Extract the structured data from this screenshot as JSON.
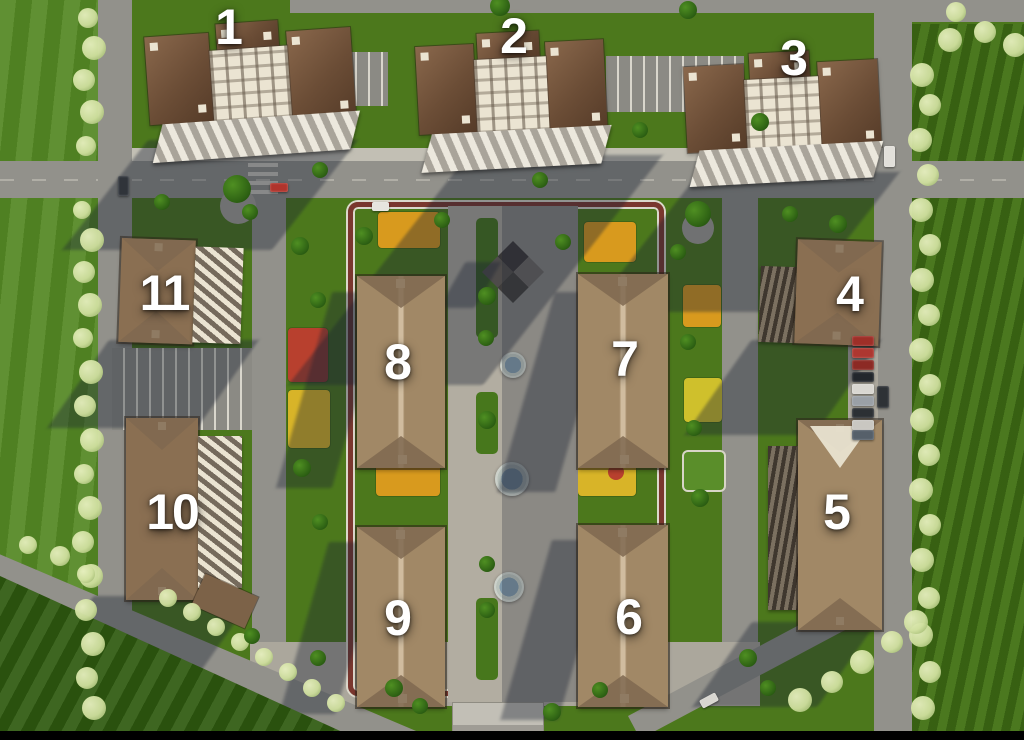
{
  "scene": {
    "title": "Residential complex aerial master plan",
    "type": "3d-aerial-render",
    "building_count": 11
  },
  "buildings": [
    {
      "label": "1",
      "kind": "high-rise-tower"
    },
    {
      "label": "2",
      "kind": "high-rise-tower"
    },
    {
      "label": "3",
      "kind": "high-rise-tower"
    },
    {
      "label": "4",
      "kind": "perimeter-mid-rise"
    },
    {
      "label": "5",
      "kind": "perimeter-mid-rise"
    },
    {
      "label": "6",
      "kind": "courtyard-mid-rise"
    },
    {
      "label": "7",
      "kind": "courtyard-mid-rise"
    },
    {
      "label": "8",
      "kind": "courtyard-mid-rise"
    },
    {
      "label": "9",
      "kind": "courtyard-mid-rise"
    },
    {
      "label": "10",
      "kind": "perimeter-mid-rise"
    },
    {
      "label": "11",
      "kind": "perimeter-mid-rise"
    }
  ],
  "colors": {
    "grass": "#4c781c",
    "road": "#92918b",
    "paving": "#aba79c",
    "roof_tan": "#a18866",
    "hip_shade": "#7f6850",
    "facade": "#ebe4d2",
    "stripe_dark": "#756a5c",
    "track": "#7a372e",
    "track_edge": "#dcd8cc",
    "playground_orange": "#d89a1e",
    "playground_yellow": "#d8b428",
    "playground_red": "#b8402e",
    "playground_green": "#5a8e2a",
    "water": "#7f98a8",
    "fountain_rim": "#ccd1ca",
    "shadow": "rgba(26,33,50,0.38)",
    "tree_green": "#2f6314",
    "tree_flower": "#cfdf9e",
    "label": "#ffffff",
    "letterbox": "#000000"
  },
  "decor": {
    "flowering_trees": [
      [
        88,
        18,
        10
      ],
      [
        94,
        48,
        12
      ],
      [
        84,
        80,
        11
      ],
      [
        92,
        112,
        12
      ],
      [
        86,
        146,
        10
      ],
      [
        82,
        210,
        9
      ],
      [
        92,
        240,
        12
      ],
      [
        84,
        272,
        11
      ],
      [
        90,
        305,
        12
      ],
      [
        83,
        338,
        10
      ],
      [
        91,
        372,
        12
      ],
      [
        85,
        406,
        11
      ],
      [
        92,
        440,
        12
      ],
      [
        84,
        474,
        10
      ],
      [
        90,
        508,
        12
      ],
      [
        83,
        542,
        11
      ],
      [
        91,
        576,
        12
      ],
      [
        86,
        610,
        11
      ],
      [
        93,
        644,
        12
      ],
      [
        87,
        678,
        11
      ],
      [
        94,
        708,
        12
      ],
      [
        922,
        75,
        12
      ],
      [
        930,
        105,
        11
      ],
      [
        920,
        140,
        12
      ],
      [
        928,
        175,
        11
      ],
      [
        921,
        210,
        12
      ],
      [
        930,
        245,
        11
      ],
      [
        922,
        280,
        12
      ],
      [
        929,
        315,
        11
      ],
      [
        921,
        350,
        12
      ],
      [
        930,
        385,
        11
      ],
      [
        922,
        420,
        12
      ],
      [
        929,
        455,
        11
      ],
      [
        921,
        490,
        12
      ],
      [
        930,
        525,
        11
      ],
      [
        922,
        560,
        12
      ],
      [
        929,
        598,
        11
      ],
      [
        921,
        635,
        12
      ],
      [
        930,
        672,
        11
      ],
      [
        923,
        708,
        12
      ],
      [
        950,
        40,
        12
      ],
      [
        985,
        32,
        11
      ],
      [
        1015,
        45,
        12
      ],
      [
        956,
        12,
        10
      ],
      [
        168,
        598,
        9
      ],
      [
        192,
        612,
        9
      ],
      [
        216,
        627,
        9
      ],
      [
        240,
        642,
        9
      ],
      [
        264,
        657,
        9
      ],
      [
        288,
        672,
        9
      ],
      [
        312,
        688,
        9
      ],
      [
        336,
        703,
        9
      ],
      [
        800,
        700,
        12
      ],
      [
        832,
        682,
        11
      ],
      [
        862,
        662,
        12
      ],
      [
        892,
        642,
        11
      ],
      [
        916,
        622,
        12
      ],
      [
        60,
        556,
        10
      ],
      [
        28,
        545,
        9
      ],
      [
        86,
        574,
        9
      ]
    ],
    "green_trees": [
      [
        237,
        189,
        14
      ],
      [
        698,
        214,
        13
      ],
      [
        364,
        236,
        9
      ],
      [
        442,
        220,
        8
      ],
      [
        487,
        296,
        9
      ],
      [
        486,
        338,
        8
      ],
      [
        487,
        420,
        9
      ],
      [
        487,
        564,
        8
      ],
      [
        487,
        610,
        8
      ],
      [
        563,
        242,
        8
      ],
      [
        300,
        246,
        9
      ],
      [
        318,
        300,
        8
      ],
      [
        302,
        468,
        9
      ],
      [
        320,
        522,
        8
      ],
      [
        688,
        342,
        8
      ],
      [
        694,
        428,
        8
      ],
      [
        700,
        498,
        9
      ],
      [
        678,
        252,
        8
      ],
      [
        394,
        688,
        9
      ],
      [
        420,
        706,
        8
      ],
      [
        318,
        658,
        8
      ],
      [
        748,
        658,
        9
      ],
      [
        768,
        688,
        8
      ],
      [
        252,
        636,
        8
      ],
      [
        552,
        712,
        9
      ],
      [
        600,
        690,
        8
      ],
      [
        500,
        6,
        10
      ],
      [
        688,
        10,
        9
      ],
      [
        760,
        122,
        9
      ],
      [
        640,
        130,
        8
      ],
      [
        162,
        202,
        8
      ],
      [
        250,
        212,
        8
      ],
      [
        838,
        224,
        9
      ],
      [
        790,
        214,
        8
      ],
      [
        540,
        180,
        8
      ],
      [
        320,
        170,
        8
      ]
    ],
    "cars": [
      {
        "x": 118,
        "y": 176,
        "w": 11,
        "h": 20,
        "c": "#30343a",
        "r": 0
      },
      {
        "x": 270,
        "y": 183,
        "w": 18,
        "h": 9,
        "c": "#b0342c",
        "r": 0
      },
      {
        "x": 372,
        "y": 202,
        "w": 17,
        "h": 9,
        "c": "#e6e4de",
        "r": 0
      },
      {
        "x": 884,
        "y": 146,
        "w": 11,
        "h": 21,
        "c": "#e2e0da",
        "r": 0
      },
      {
        "x": 877,
        "y": 386,
        "w": 12,
        "h": 22,
        "c": "#2e3236",
        "r": 0
      },
      {
        "x": 700,
        "y": 696,
        "w": 18,
        "h": 9,
        "c": "#d8d6d0",
        "r": -28
      },
      {
        "x": 852,
        "y": 336,
        "w": 22,
        "h": 10,
        "c": "#9e2f28",
        "r": 0
      },
      {
        "x": 852,
        "y": 348,
        "w": 22,
        "h": 10,
        "c": "#ad3730",
        "r": 0
      },
      {
        "x": 852,
        "y": 360,
        "w": 22,
        "h": 10,
        "c": "#8c2a24",
        "r": 0
      },
      {
        "x": 852,
        "y": 372,
        "w": 22,
        "h": 10,
        "c": "#23272c",
        "r": 0
      },
      {
        "x": 852,
        "y": 384,
        "w": 22,
        "h": 10,
        "c": "#d9d7d1",
        "r": 0
      },
      {
        "x": 852,
        "y": 396,
        "w": 22,
        "h": 10,
        "c": "#9aa0a6",
        "r": 0
      },
      {
        "x": 852,
        "y": 408,
        "w": 22,
        "h": 10,
        "c": "#2c3034",
        "r": 0
      },
      {
        "x": 852,
        "y": 420,
        "w": 22,
        "h": 10,
        "c": "#c9c7c1",
        "r": 0
      },
      {
        "x": 852,
        "y": 430,
        "w": 22,
        "h": 10,
        "c": "#56606a",
        "r": 0
      }
    ]
  }
}
